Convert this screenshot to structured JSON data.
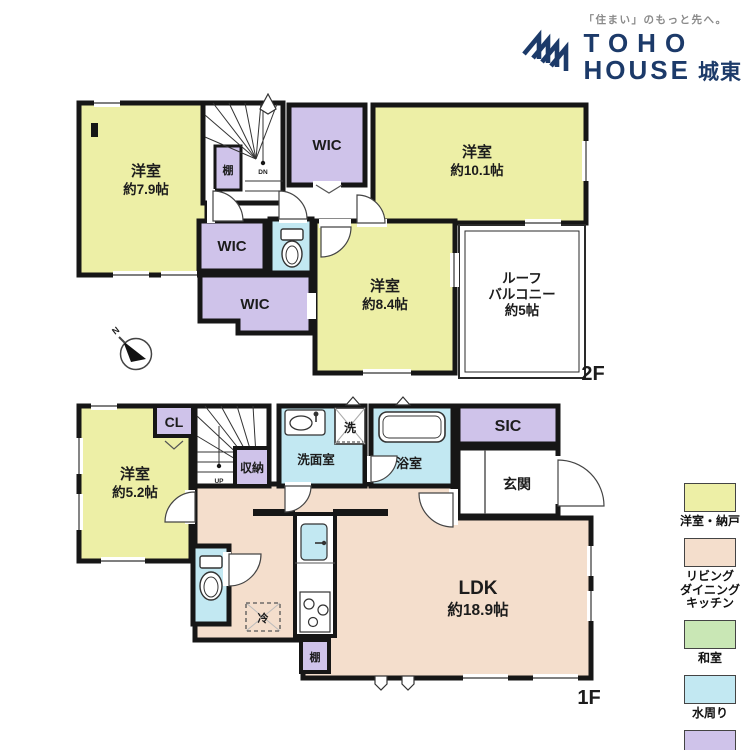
{
  "logo": {
    "tagline": "「住まい」のもっと先へ。",
    "brand_line1": "TOHO",
    "brand_line2": "HOUSE",
    "branch": "城東"
  },
  "colors": {
    "navy": "#1C3A69",
    "wall": "#161616",
    "room_yellow": "#EDEFA6",
    "room_pink": "#F4DECC",
    "room_green": "#C9E7B5",
    "room_blue": "#C2E8F2",
    "room_purple": "#CFC3EA",
    "white": "#FFFFFF"
  },
  "plan2f": {
    "floor_label": "2F",
    "room79_name": "洋室",
    "room79_size": "約7.9帖",
    "wic_top": "WIC",
    "room101_name": "洋室",
    "room101_size": "約10.1帖",
    "shelf": "棚",
    "dn": "DN",
    "wic_mid": "WIC",
    "wic_low": "WIC",
    "room84_name": "洋室",
    "room84_size": "約8.4帖",
    "balcony_line1": "ルーフ",
    "balcony_line2": "バルコニー",
    "balcony_line3": "約5帖"
  },
  "plan1f": {
    "floor_label": "1F",
    "room52_name": "洋室",
    "room52_size": "約5.2帖",
    "cl": "CL",
    "up": "UP",
    "storage": "収納",
    "washroom": "洗面室",
    "laundry": "洗",
    "bathroom": "浴室",
    "sic": "SIC",
    "entrance": "玄関",
    "ldk_name": "LDK",
    "ldk_size": "約18.9帖",
    "fridge": "冷",
    "shelf": "棚"
  },
  "compass": {
    "north": "N"
  },
  "legend": {
    "items": [
      {
        "label": "洋室・納戸",
        "color": "#EDEFA6"
      },
      {
        "label": "リビング\nダイニング\nキッチン",
        "color": "#F4DECC"
      },
      {
        "label": "和室",
        "color": "#C9E7B5"
      },
      {
        "label": "水周り",
        "color": "#C2E8F2"
      },
      {
        "label": "収納",
        "color": "#CFC3EA"
      }
    ]
  }
}
